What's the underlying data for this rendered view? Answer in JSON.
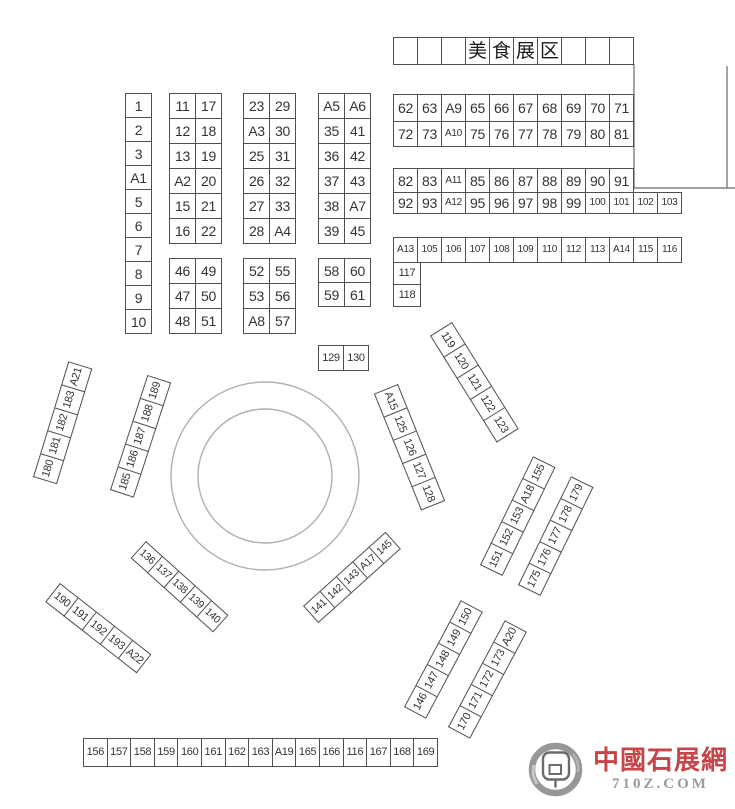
{
  "colors": {
    "border": "#4f4f4f",
    "text": "#333333",
    "circle": "#b0b0b0",
    "wall": "#6a6a6a"
  },
  "header_title_cells": [
    "",
    "",
    "",
    "美",
    "食",
    "展",
    "区",
    "",
    "",
    ""
  ],
  "blocks": [
    {
      "name": "header-food-zone",
      "x": 393,
      "y": 37,
      "cw": 24,
      "ch": 27,
      "fs": 19,
      "cls": "cjk",
      "rows": [
        [
          "",
          "",
          "",
          "美",
          "食",
          "展",
          "区",
          "",
          "",
          ""
        ]
      ]
    },
    {
      "name": "row-62-71",
      "x": 393,
      "y": 94,
      "cw": 24,
      "ch": 27,
      "fs": 14,
      "rows": [
        [
          "62",
          "63",
          "A9",
          "65",
          "66",
          "67",
          "68",
          "69",
          "70",
          "71"
        ]
      ]
    },
    {
      "name": "row-72-81",
      "x": 393,
      "y": 121,
      "cw": 24,
      "ch": 25,
      "fs": 14,
      "rows": [
        [
          "72",
          "73",
          "A10",
          "75",
          "76",
          "77",
          "78",
          "79",
          "80",
          "81"
        ]
      ]
    },
    {
      "name": "row-82-91",
      "x": 393,
      "y": 168,
      "cw": 24,
      "ch": 24,
      "fs": 14,
      "rows": [
        [
          "82",
          "83",
          "A11",
          "85",
          "86",
          "87",
          "88",
          "89",
          "90",
          "91"
        ]
      ]
    },
    {
      "name": "row-92-103",
      "x": 393,
      "y": 192,
      "cw": 24,
      "ch": 21,
      "fs": 14,
      "rows": [
        [
          "92",
          "93",
          "A12",
          "95",
          "96",
          "97",
          "98",
          "99",
          "100",
          "101",
          "102",
          "103"
        ]
      ]
    },
    {
      "name": "row-a13-116",
      "x": 393,
      "y": 237,
      "cw": 24,
      "ch": 25,
      "fs": 10,
      "rows": [
        [
          "A13",
          "105",
          "106",
          "107",
          "108",
          "109",
          "110",
          "112",
          "113",
          "A14",
          "115",
          "116"
        ]
      ]
    },
    {
      "name": "col-117-118",
      "x": 393,
      "y": 262,
      "cw": 27,
      "ch": 22,
      "fs": 11,
      "rows": [
        [
          "117"
        ],
        [
          "118"
        ]
      ]
    },
    {
      "name": "col-1-6",
      "x": 125,
      "y": 93,
      "cw": 26,
      "ch": 24,
      "fs": 14,
      "rows": [
        [
          "1"
        ],
        [
          "2"
        ],
        [
          "3"
        ],
        [
          "A1"
        ],
        [
          "5"
        ],
        [
          "6"
        ]
      ]
    },
    {
      "name": "col-7-10",
      "x": 125,
      "y": 237,
      "cw": 26,
      "ch": 24,
      "fs": 14,
      "rows": [
        [
          "7"
        ],
        [
          "8"
        ],
        [
          "9"
        ],
        [
          "10"
        ]
      ]
    },
    {
      "name": "block-11-22",
      "x": 169,
      "y": 93,
      "cw": 26,
      "ch": 25,
      "fs": 14,
      "rows": [
        [
          "11",
          "17"
        ],
        [
          "12",
          "18"
        ],
        [
          "13",
          "19"
        ],
        [
          "A2",
          "20"
        ],
        [
          "15",
          "21"
        ],
        [
          "16",
          "22"
        ]
      ]
    },
    {
      "name": "block-23-34",
      "x": 243,
      "y": 93,
      "cw": 26,
      "ch": 25,
      "fs": 14,
      "rows": [
        [
          "23",
          "29"
        ],
        [
          "A3",
          "30"
        ],
        [
          "25",
          "31"
        ],
        [
          "26",
          "32"
        ],
        [
          "27",
          "33"
        ],
        [
          "28",
          "A4"
        ]
      ]
    },
    {
      "name": "block-35-45",
      "x": 318,
      "y": 93,
      "cw": 26,
      "ch": 25,
      "fs": 14,
      "rows": [
        [
          "A5",
          "A6"
        ],
        [
          "35",
          "41"
        ],
        [
          "36",
          "42"
        ],
        [
          "37",
          "43"
        ],
        [
          "38",
          "A7"
        ],
        [
          "39",
          "45"
        ]
      ]
    },
    {
      "name": "block-46-51",
      "x": 169,
      "y": 258,
      "cw": 26,
      "ch": 25,
      "fs": 14,
      "rows": [
        [
          "46",
          "49"
        ],
        [
          "47",
          "50"
        ],
        [
          "48",
          "51"
        ]
      ]
    },
    {
      "name": "block-52-57",
      "x": 243,
      "y": 258,
      "cw": 26,
      "ch": 25,
      "fs": 14,
      "rows": [
        [
          "52",
          "55"
        ],
        [
          "53",
          "56"
        ],
        [
          "A8",
          "57"
        ]
      ]
    },
    {
      "name": "block-58-61",
      "x": 318,
      "y": 258,
      "cw": 26,
      "ch": 24,
      "fs": 14,
      "rows": [
        [
          "58",
          "60"
        ],
        [
          "59",
          "61"
        ]
      ]
    },
    {
      "name": "pair-129-130",
      "x": 318,
      "y": 345,
      "cw": 25,
      "ch": 25,
      "fs": 11,
      "rows": [
        [
          "129",
          "130"
        ]
      ]
    },
    {
      "name": "row-156-169",
      "x": 83,
      "y": 738,
      "cw": 23.6,
      "ch": 28,
      "fs": 11,
      "rows": [
        [
          "156",
          "157",
          "158",
          "159",
          "160",
          "161",
          "162",
          "163",
          "A19",
          "165",
          "166",
          "116",
          "167",
          "168",
          "169"
        ]
      ]
    },
    {
      "name": "strip-119-123",
      "x": 452,
      "y": 322,
      "rot": 58,
      "cw": 25,
      "ch": 25,
      "fs": 11,
      "rows": [
        [
          "119",
          "120",
          "121",
          "122",
          "123"
        ]
      ]
    },
    {
      "name": "strip-a15-128",
      "x": 398,
      "y": 384,
      "rot": 68,
      "cw": 25,
      "ch": 25,
      "fs": 11,
      "rows": [
        [
          "A15",
          "125",
          "126",
          "127",
          "128"
        ]
      ]
    },
    {
      "name": "strip-180-a21",
      "x": 33,
      "y": 477,
      "rot": -73,
      "cw": 24,
      "ch": 24,
      "fs": 11,
      "rows": [
        [
          "180",
          "181",
          "182",
          "183",
          "A21"
        ]
      ]
    },
    {
      "name": "strip-185-189",
      "x": 110,
      "y": 490,
      "rot": -72,
      "cw": 24,
      "ch": 24,
      "fs": 11,
      "rows": [
        [
          "185",
          "186",
          "187",
          "188",
          "189"
        ]
      ]
    },
    {
      "name": "strip-136-140",
      "x": 146,
      "y": 541,
      "rot": 42,
      "cw": 22,
      "ch": 22,
      "fs": 10.5,
      "rows": [
        [
          "136",
          "137",
          "138",
          "139",
          "140"
        ]
      ]
    },
    {
      "name": "strip-190-a22",
      "x": 60,
      "y": 583,
      "rot": 38,
      "cw": 23,
      "ch": 23,
      "fs": 11,
      "rows": [
        [
          "190",
          "191",
          "192",
          "193",
          "A22"
        ]
      ]
    },
    {
      "name": "strip-141-145",
      "x": 303,
      "y": 606,
      "rot": -42,
      "cw": 22,
      "ch": 22,
      "fs": 10.5,
      "rows": [
        [
          "141",
          "142",
          "143",
          "A17",
          "145"
        ]
      ]
    },
    {
      "name": "strip-146-150",
      "x": 404,
      "y": 707,
      "rot": -62,
      "cw": 24,
      "ch": 24,
      "fs": 11,
      "rows": [
        [
          "146",
          "147",
          "148",
          "149",
          "150"
        ]
      ]
    },
    {
      "name": "strip-170-a20",
      "x": 448,
      "y": 727,
      "rot": -62,
      "cw": 24,
      "ch": 24,
      "fs": 11,
      "rows": [
        [
          "170",
          "171",
          "172",
          "173",
          "A20"
        ]
      ]
    },
    {
      "name": "strip-151-155",
      "x": 480,
      "y": 565,
      "rot": -64,
      "cw": 24,
      "ch": 24,
      "fs": 11,
      "rows": [
        [
          "151",
          "152",
          "153",
          "A18",
          "155"
        ]
      ]
    },
    {
      "name": "strip-175-179",
      "x": 518,
      "y": 585,
      "rot": -64,
      "cw": 24,
      "ch": 24,
      "fs": 11,
      "rows": [
        [
          "175",
          "176",
          "177",
          "178",
          "179"
        ]
      ]
    }
  ],
  "circle": {
    "cx": 265,
    "cy": 476,
    "r_outer": 94,
    "r_inner": 67
  },
  "walls": [
    {
      "x1": 634,
      "y1": 64,
      "x2": 634,
      "y2": 188
    },
    {
      "x1": 727,
      "y1": 66,
      "x2": 727,
      "y2": 188
    },
    {
      "x1": 634,
      "y1": 188,
      "x2": 735,
      "y2": 188
    }
  ],
  "logo": {
    "name": "中國石展網",
    "domain": "710Z.COM",
    "name_color": "#c64549",
    "domain_color": "#9b9b9b"
  }
}
